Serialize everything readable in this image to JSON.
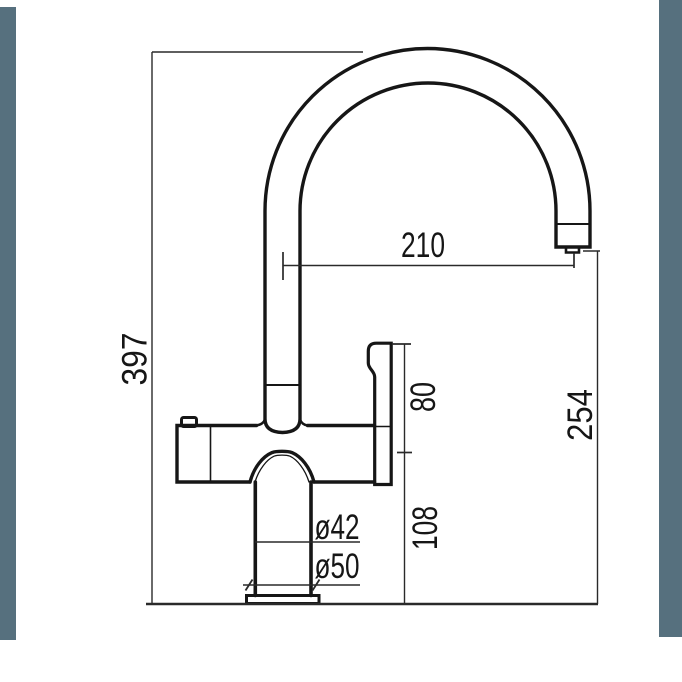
{
  "drawing": {
    "kind": "faucet-technical-drawing",
    "units": "mm",
    "labels": {
      "total_height": "397",
      "spout_reach": "210",
      "outlet_height": "254",
      "handle_height": "80",
      "lower_body_height": "108",
      "body_diameter": "ø42",
      "base_diameter": "ø50"
    },
    "colors": {
      "line": "#161616",
      "background": "#ffffff",
      "page_edge": "#56707e"
    }
  }
}
